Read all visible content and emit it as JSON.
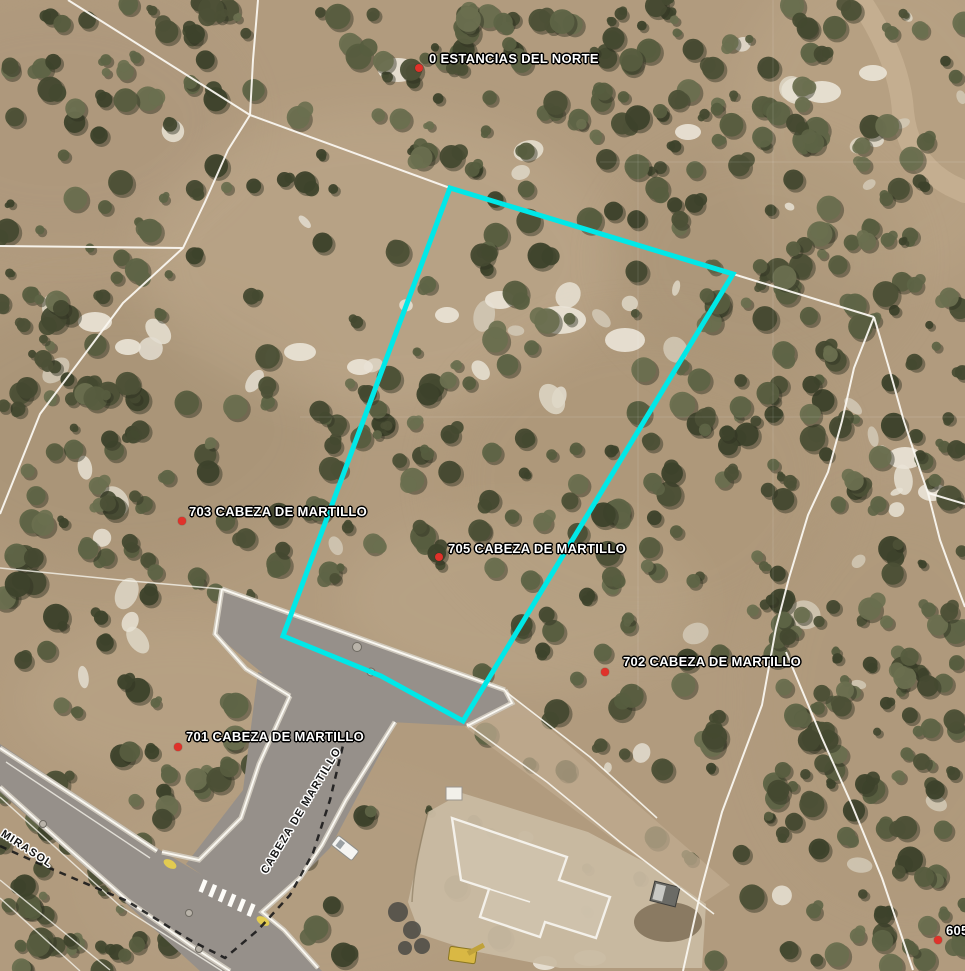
{
  "map": {
    "type": "aerial-parcel-map",
    "labels": {
      "parcel_addresses": [
        {
          "text": "0 ESTANCIAS DEL NORTE",
          "x": 429,
          "y": 51,
          "dot_x": 419,
          "dot_y": 68
        },
        {
          "text": "703 CABEZA DE MARTILLO",
          "x": 189,
          "y": 504,
          "dot_x": 182,
          "dot_y": 521
        },
        {
          "text": "705 CABEZA DE MARTILLO",
          "x": 448,
          "y": 541,
          "dot_x": 439,
          "dot_y": 557
        },
        {
          "text": "702 CABEZA DE MARTILLO",
          "x": 623,
          "y": 654,
          "dot_x": 605,
          "dot_y": 672
        },
        {
          "text": "701 CABEZA DE MARTILLO",
          "x": 186,
          "y": 729,
          "dot_x": 178,
          "dot_y": 747
        },
        {
          "text": "605",
          "x": 946,
          "y": 923,
          "dot_x": 938,
          "dot_y": 940
        }
      ],
      "street_names": [
        {
          "text": "CABEZA DE MARTILLO",
          "x": 264,
          "y": 867,
          "rotation": -59
        },
        {
          "text": "MIRASOL",
          "x": 2,
          "y": 827,
          "rotation": 33
        }
      ]
    },
    "selected_parcel": {
      "address": "705 CABEZA DE MARTILLO",
      "outline": [
        [
          450,
          188
        ],
        [
          733,
          274
        ],
        [
          463,
          721
        ],
        [
          381,
          676
        ],
        [
          283,
          636
        ]
      ]
    },
    "colors": {
      "highlight": "#00e8e8",
      "parcel_line": "#faf7f0",
      "address_dot": "#e0322a",
      "address_text": "#ffffff",
      "street_text": "#141414",
      "road_asphalt": "#96908a",
      "terrain_base": "#b19b7e",
      "boundary_dash": "#1a1a1a"
    }
  }
}
